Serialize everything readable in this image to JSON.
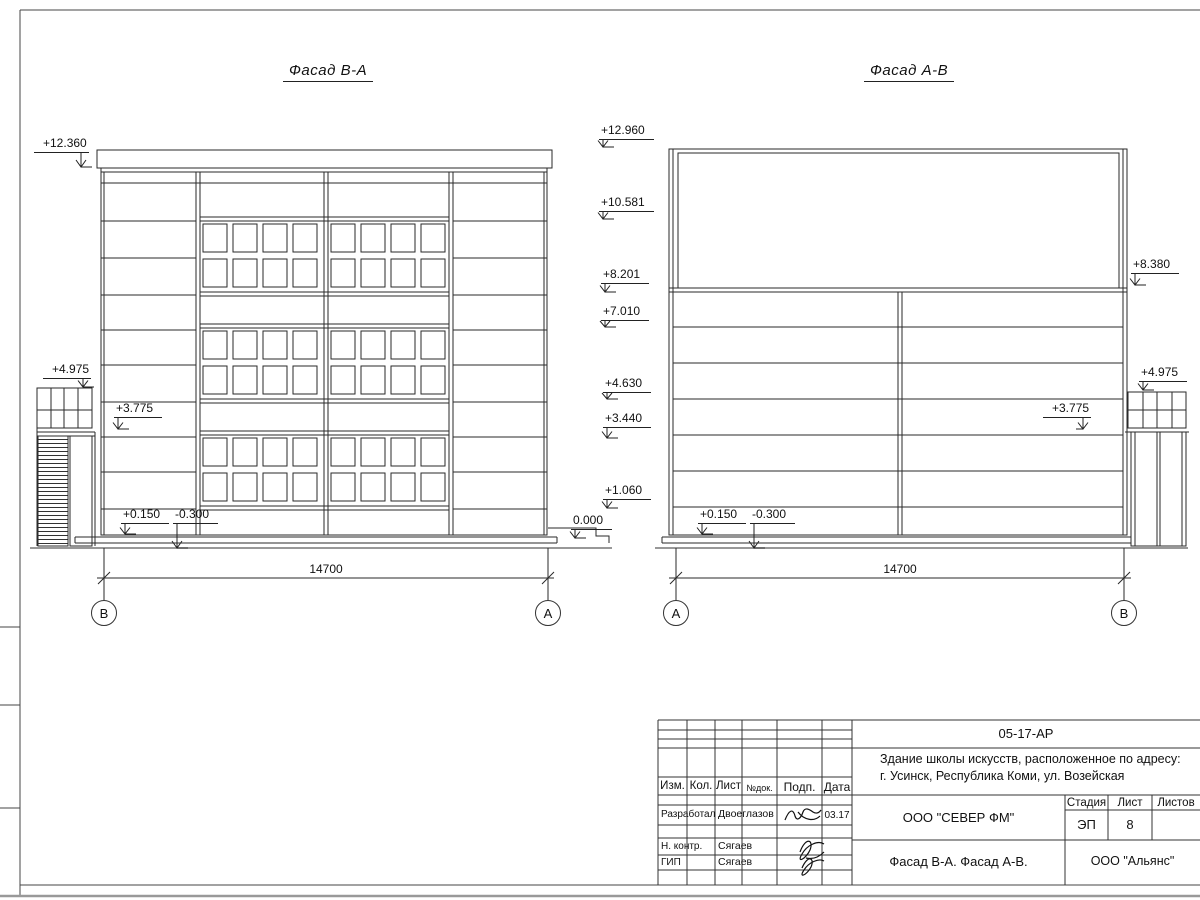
{
  "drawing": {
    "left_facade": {
      "title": "Фасад В-А",
      "elevations": {
        "parapet": "+12.360",
        "stair_top": "+4.975",
        "canopy": "+3.775",
        "floor": "+0.150",
        "ground": "-0.300"
      },
      "dimension": "14700",
      "axis_left": "В",
      "axis_right": "А"
    },
    "center_elevations": [
      "+12.960",
      "+10.581",
      "+8.201",
      "+7.010",
      "+4.630",
      "+3.440",
      "+1.060",
      "0.000"
    ],
    "right_facade": {
      "title": "Фасад А-В",
      "elevations": {
        "floor": "+0.150",
        "ground": "-0.300",
        "canopy": "+3.775",
        "panel_top": "+8.380",
        "stair_top": "+4.975"
      },
      "dimension": "14700",
      "axis_left": "А",
      "axis_right": "В"
    }
  },
  "title_block": {
    "doc_number": "05-17-АР",
    "project_name_line1": "Здание школы искусств, расположенное по адресу:",
    "project_name_line2": "г. Усинск, Республика Коми, ул. Возейская",
    "headers": {
      "izm": "Изм.",
      "kol": "Кол.",
      "list": "Лист",
      "doc": "№док.",
      "podp": "Подп.",
      "data": "Дата"
    },
    "signature_rows": [
      {
        "role": "Разработал",
        "name": "Двоеглазов",
        "date": "03.17"
      },
      {
        "role": "Н. контр.",
        "name": "Сягаев",
        "date": ""
      },
      {
        "role": "ГИП",
        "name": "Сягаев",
        "date": ""
      }
    ],
    "designer_company": "ООО \"СЕВЕР ФМ\"",
    "stage_label": "Стадия",
    "sheet_label": "Лист",
    "sheets_label": "Листов",
    "stage_value": "ЭП",
    "sheet_value": "8",
    "sheets_value": "",
    "sheet_title": "Фасад В-А. Фасад А-В.",
    "contractor_company": "ООО \"Альянс\""
  }
}
